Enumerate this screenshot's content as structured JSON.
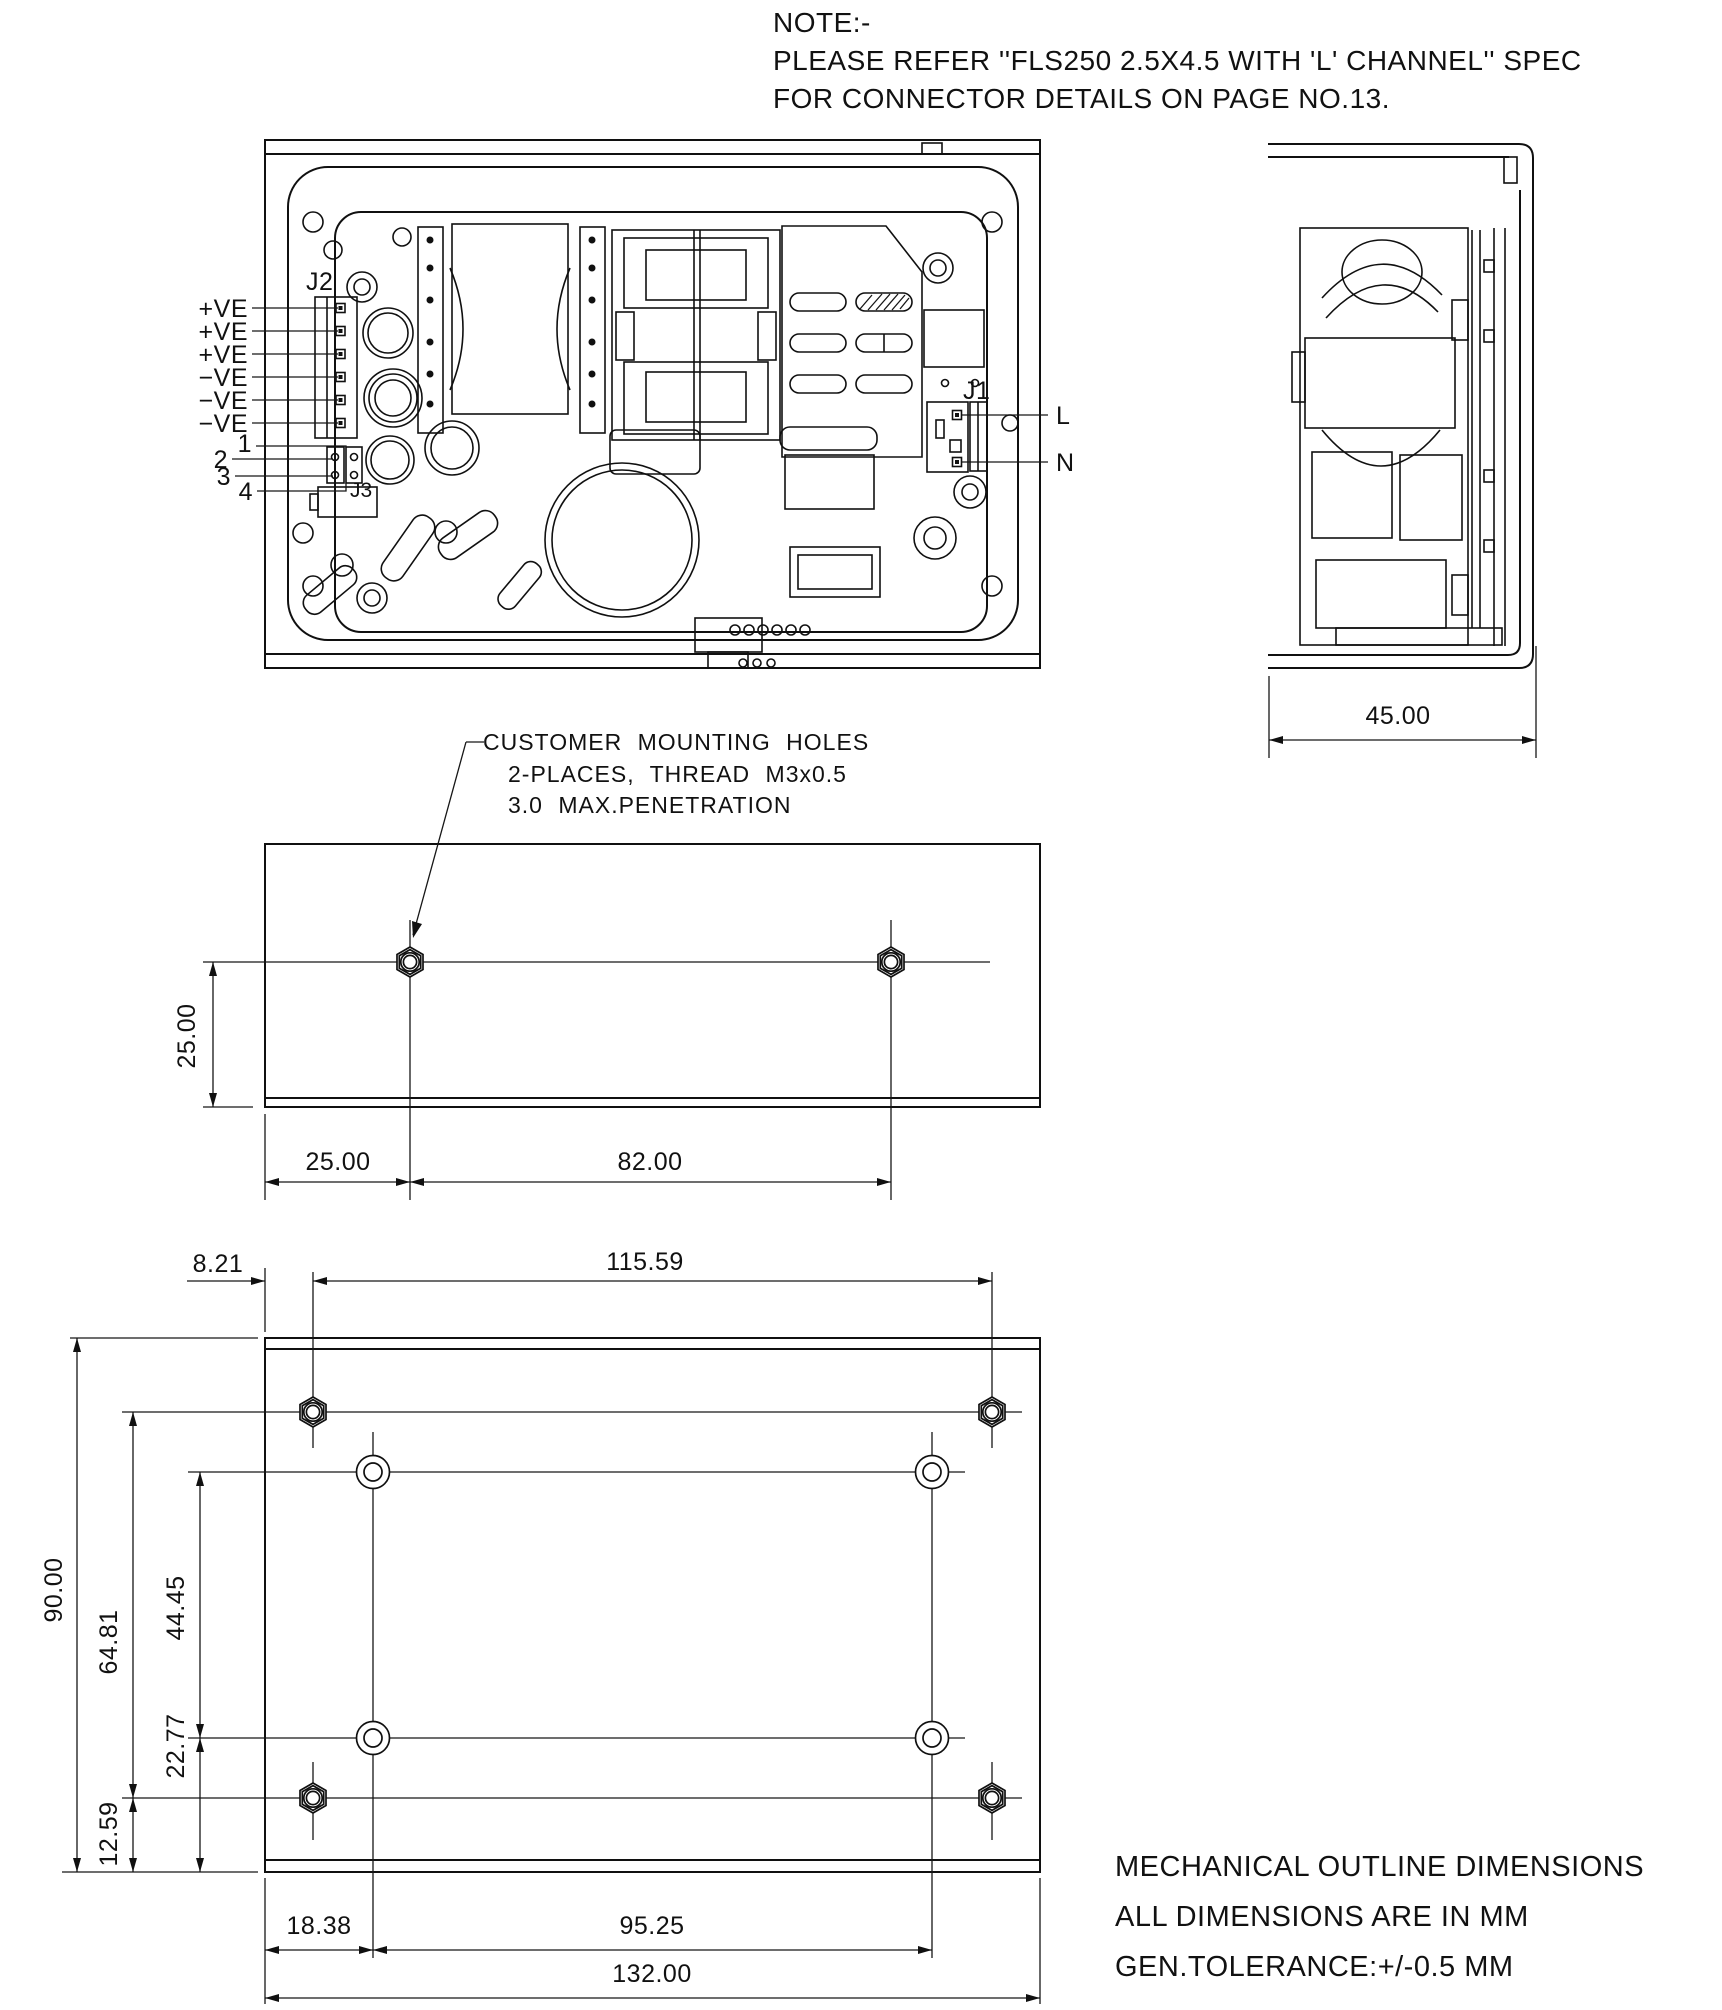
{
  "note": {
    "line1": "NOTE:-",
    "line2": "PLEASE REFER ''FLS250 2.5X4.5 WITH 'L' CHANNEL'' SPEC",
    "line3": "FOR CONNECTOR DETAILS ON PAGE NO.13."
  },
  "top_view": {
    "j2_label": "J2",
    "j3_label": "J3",
    "j1_label": "J1",
    "pins": [
      "+VE",
      "+VE",
      "+VE",
      "−VE",
      "−VE",
      "−VE"
    ],
    "nums": [
      "1",
      "2",
      "3",
      "4"
    ],
    "line_label": "L",
    "neutral_label": "N"
  },
  "side_view": {
    "width_dim": "45.00"
  },
  "middle_view": {
    "callout": {
      "line1": "CUSTOMER MOUNTING HOLES",
      "line2": "2-PLACES, THREAD M3x0.5",
      "line3": "3.0 MAX.PENETRATION"
    },
    "dims": {
      "vertical": "25.00",
      "left": "25.00",
      "span": "82.00"
    }
  },
  "bottom_view": {
    "dims": {
      "top_offset": "8.21",
      "top_span": "115.59",
      "height": "90.00",
      "hex_span": "64.81",
      "circle_span": "44.45",
      "circle_offset": "22.77",
      "hex_offset": "12.59",
      "bottom_offset": "18.38",
      "bottom_span": "95.25",
      "width": "132.00"
    }
  },
  "footer": {
    "line1": "MECHANICAL OUTLINE DIMENSIONS",
    "line2": "ALL DIMENSIONS ARE IN MM",
    "line3": "GEN.TOLERANCE:+/-0.5 MM"
  }
}
